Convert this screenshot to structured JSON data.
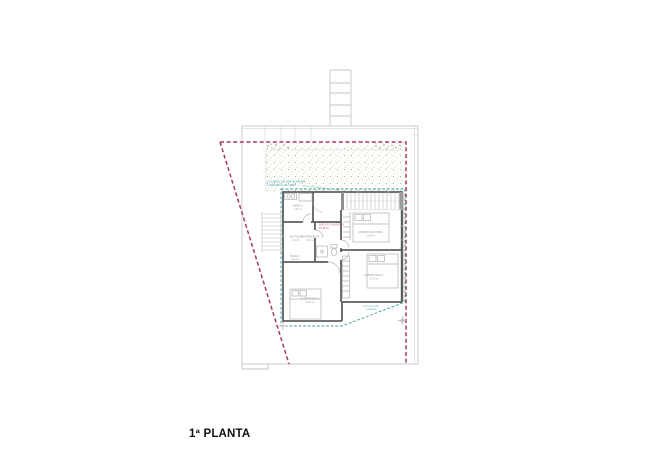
{
  "title": {
    "label": "1ª PLANTA"
  },
  "legend": {
    "line1": "1. ACABADO CELOSÍA DE MADERA",
    "line2": "2. BARANDILLA DE VIDRIO"
  },
  "area_summary": {
    "line1": "SUP. ÚTIL PLANTA 1ª",
    "line2": "57,35 m²"
  },
  "roof_note": {
    "line1": "PROYECCIÓN",
    "line2": "CUBIERTA"
  },
  "rooms": {
    "bano2": {
      "name": "BAÑO 2",
      "area": "4,05 m²"
    },
    "vestidor": {
      "name": "VESTIDOR",
      "area": "6,10 m²"
    },
    "distribuidor": {
      "name": "DISTRIBUIDOR",
      "area": "5,45 m²"
    },
    "bano1": {
      "name": "BAÑO 1",
      "area": "4,90 m²"
    },
    "dormitorio_ppal": {
      "name": "DORMITORIO PPAL.",
      "area": "13,90 m²"
    },
    "dormitorio2": {
      "name": "DORMITORIO 2",
      "area": "11,75 m²"
    },
    "dormitorio1": {
      "name": "DORMITORIO 1",
      "area": "12,60 m²"
    }
  },
  "colors": {
    "site_boundary": "#a93b54",
    "roof_projection": "#3f9d9d",
    "terrace_vegetation": "#93a35f",
    "walls": "#5e5e5e",
    "thin_lines": "#c6c6c6",
    "room_label": "#979797",
    "area_text": "#c2566c",
    "title_text": "#111111"
  }
}
